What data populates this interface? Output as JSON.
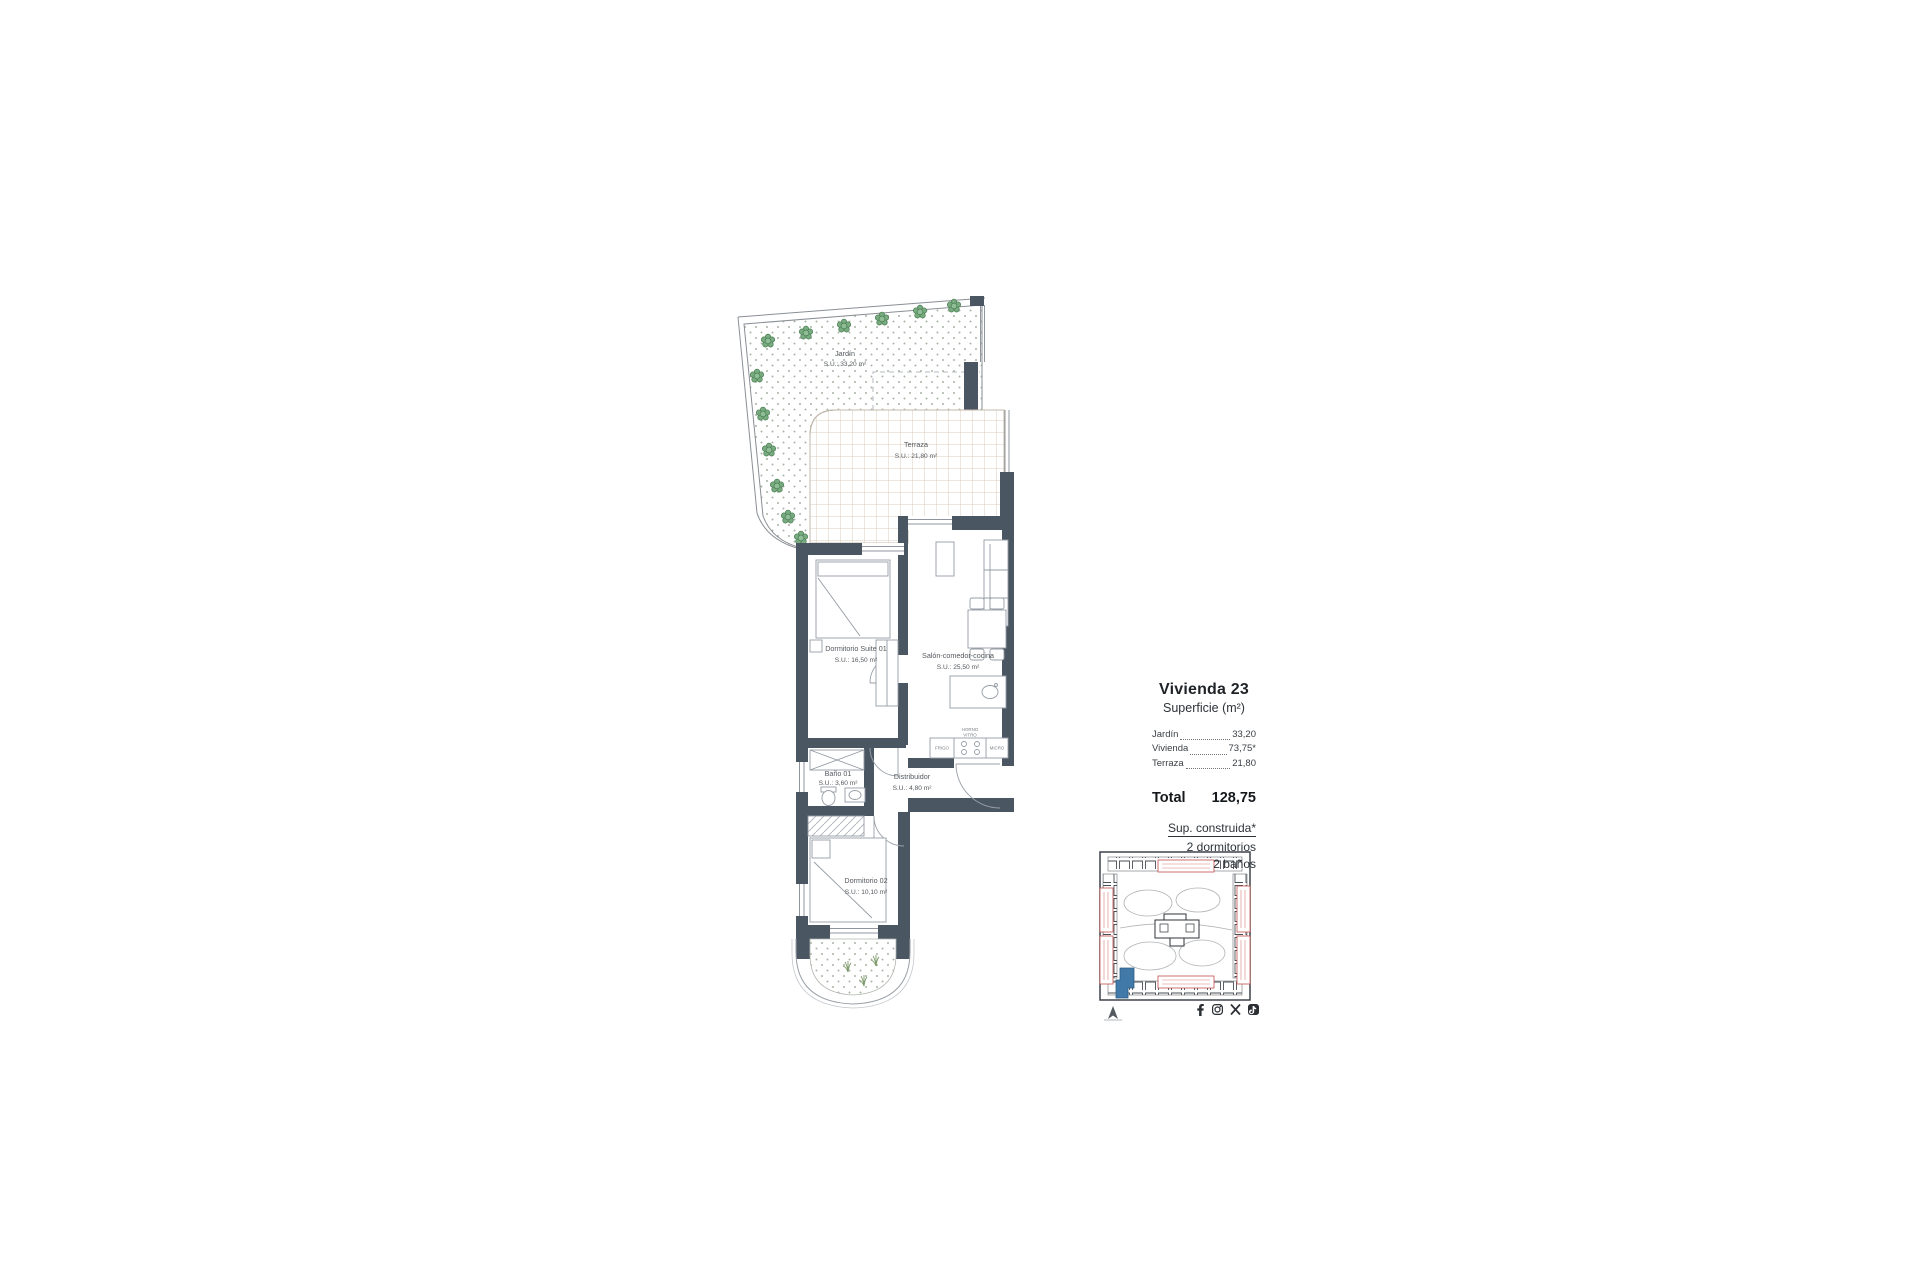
{
  "plan": {
    "rooms": [
      {
        "name": "Jardín",
        "area": "S.U.: 33,20 m²"
      },
      {
        "name": "Terraza",
        "area": "S.U.: 21,80 m²"
      },
      {
        "name": "Dormitorio Suite 01",
        "area": "S.U.: 16,50 m²"
      },
      {
        "name": "Salón-comedor-cocina",
        "area": "S.U.: 25,50 m²"
      },
      {
        "name": "Baño 01",
        "area": "S.U.: 3,60 m²"
      },
      {
        "name": "Distribuidor",
        "area": "S.U.: 4,80 m²"
      },
      {
        "name": "Dormitorio 02",
        "area": "S.U.: 10,10 m²"
      }
    ],
    "kitchen": {
      "fridge": "FRIGO",
      "oven_line1": "HORNO",
      "oven_line2": "VITRO",
      "micro": "MICRO"
    }
  },
  "panel": {
    "title": "Vivienda 23",
    "subtitle": "Superficie (m²)",
    "rows": [
      {
        "label": "Jardín",
        "value": "33,20"
      },
      {
        "label": "Vivienda",
        "value": "73,75*"
      },
      {
        "label": "Terraza",
        "value": "21,80"
      }
    ],
    "total_label": "Total",
    "total_value": "128,75",
    "built_note": "Sup. construida*",
    "features": [
      "2 dormitorios",
      "2 baños"
    ]
  },
  "icons": {
    "social": [
      "facebook",
      "instagram",
      "x",
      "tiktok"
    ],
    "north_arrow": "north-arrow"
  },
  "colors": {
    "wall": "#4b5663",
    "tree": "#79ab80",
    "terrace_grid": "#d8cdbf",
    "garden_dots": "#a9b4a6",
    "keyplan_label": "#c0504d",
    "keyplan_highlight": "#4179a8"
  }
}
